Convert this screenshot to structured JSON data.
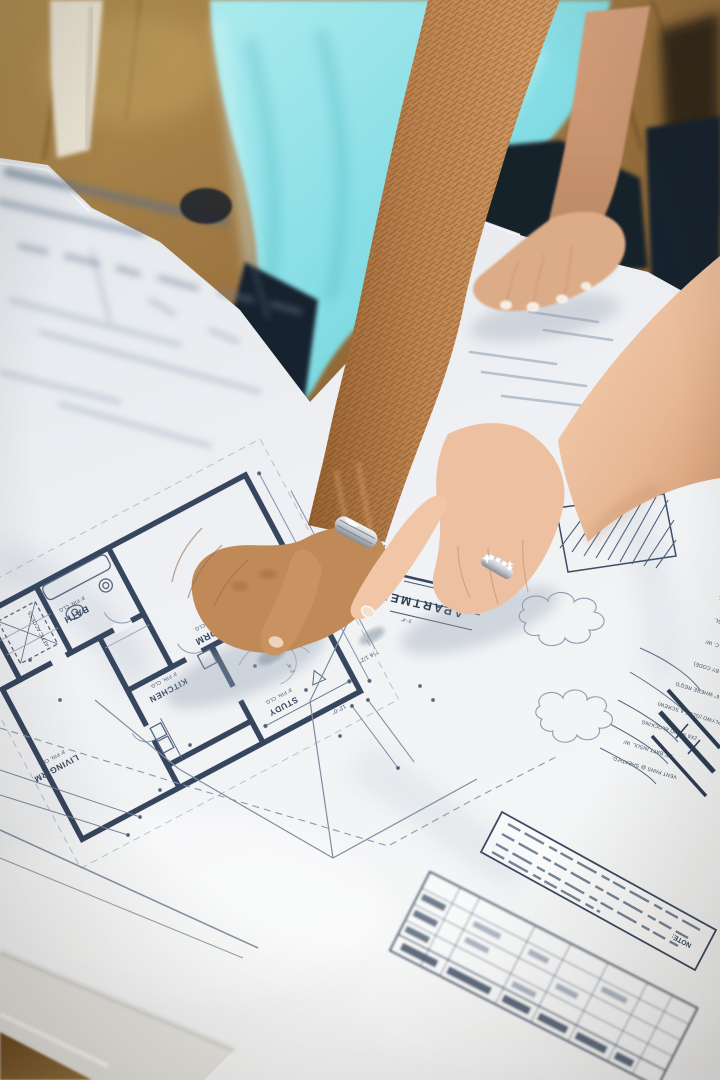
{
  "photo": {
    "subject": "hands-pointing-at-blueprint"
  },
  "blueprint": {
    "title": "APARTMENT",
    "rooms": [
      {
        "name": "BATH",
        "ceiling": "8' FIN. CLG."
      },
      {
        "name": "BEDRM",
        "ceiling": "8' FIN. CLG."
      },
      {
        "name": "KITCHEN",
        "ceiling": "8' FIN. CLG."
      },
      {
        "name": "STUDY",
        "ceiling": "8' FIN. CLG."
      },
      {
        "name": "LIVING RM",
        "ceiling": "8' FIN. CLG."
      }
    ],
    "labels": {
      "attic_access": "ATTIC ACCESS",
      "note": "NOTE:"
    },
    "dimensions": [
      "12'-0\"",
      "7'-6 1/2\"",
      "3'-4\"",
      "2'-8\""
    ],
    "construction_notes": [
      "CONC. SLAB W/ CAP. W.",
      "5/8\" DWG ON 2X10 SL.",
      "BATT INSUL. O.C. W/",
      "RAF'TD CLG. (PROPOSED BY CODE)",
      "SL02 @ 16\" WHERE REQ'D",
      "3/4\" T&G PLYWD (GLUE & SCREW)",
      "2X6 SOLID BLOCKING",
      "10\" BATT INSUL. W/",
      "VENT PANS @ SHEATH'G."
    ]
  },
  "colors": {
    "wood_floor": "#9c7440",
    "chair": "#e9e3d4",
    "shirt_turquoise": "#8fe2e8",
    "dark_clothing": "#18232e",
    "paper": "#eef0f3",
    "ink_heavy": "#36465e",
    "ink_light": "#8494a8",
    "skin_man": "#bd834f",
    "skin_woman": "#ecc0a0",
    "ring_silver": "#d9dade"
  }
}
